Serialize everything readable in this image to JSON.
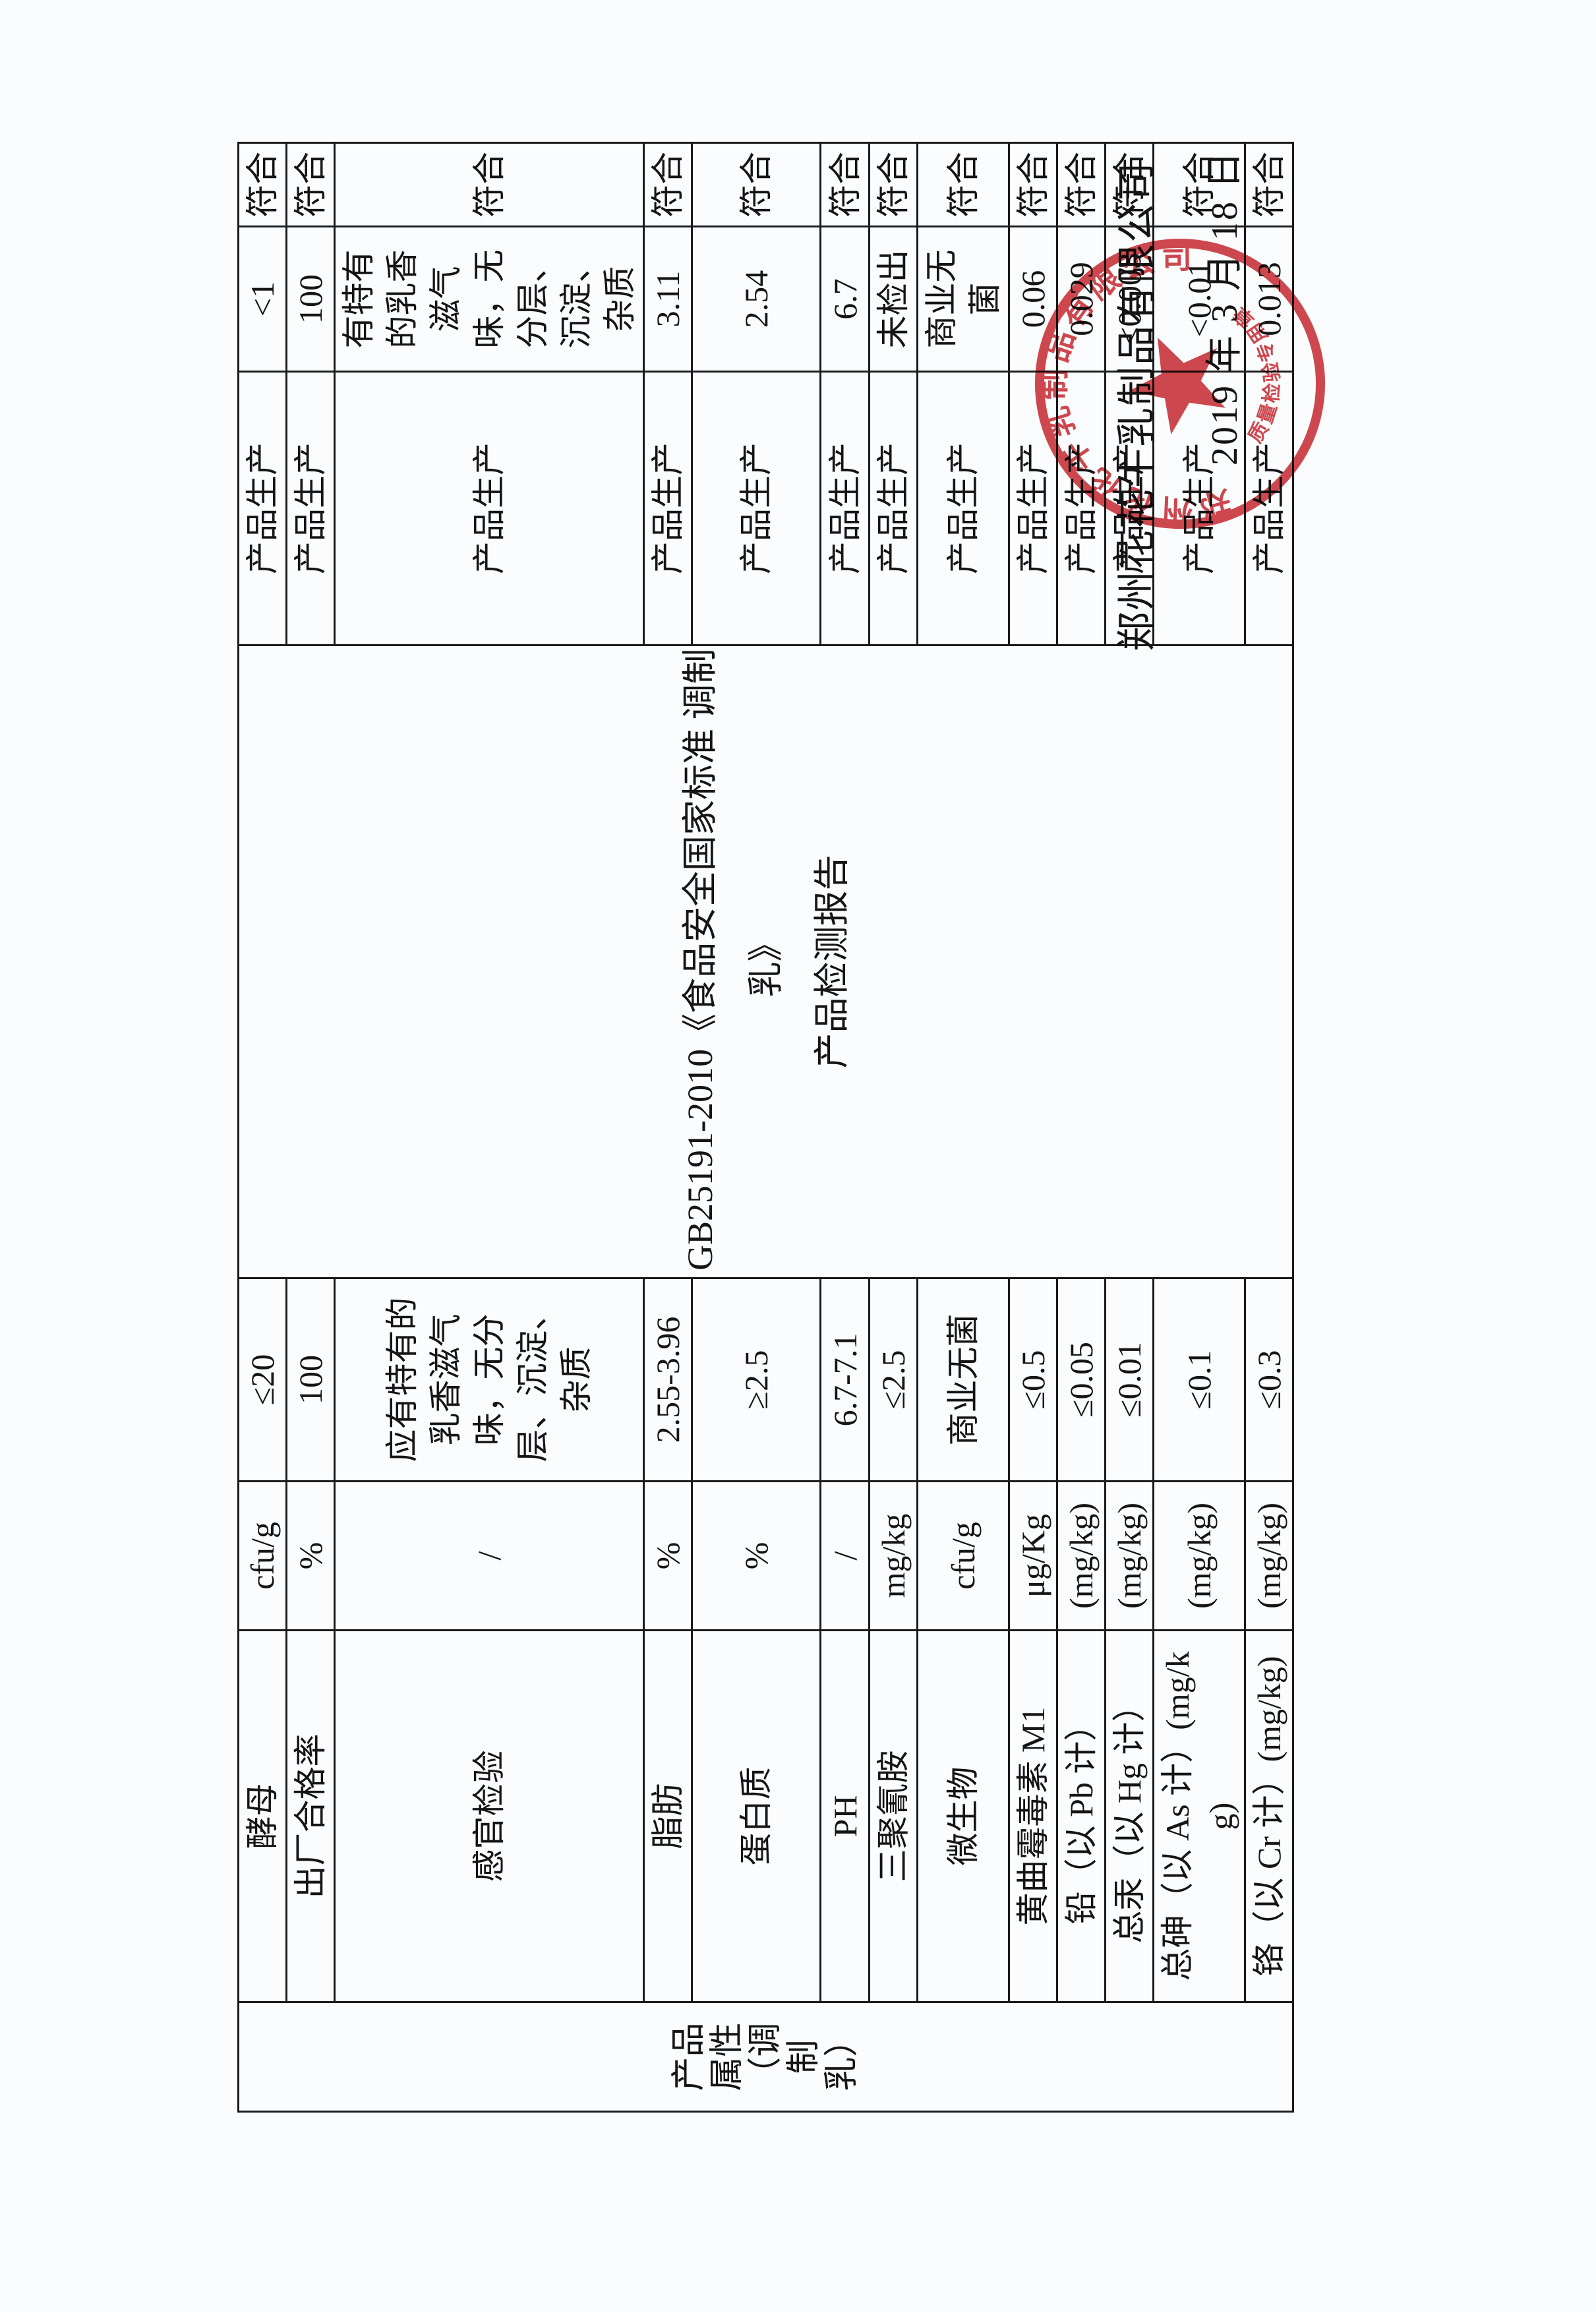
{
  "table": {
    "attribute_label": "产品属性（调制乳）",
    "basis": {
      "l1": "GB25191-2010《食品安全国家标准 调制",
      "l2": "乳》",
      "l3": "产品检测报告"
    },
    "rows": [
      {
        "item": "酵母",
        "unit": "cfu/g",
        "standard": "≤20",
        "source": "产品生产",
        "result": "<1",
        "conclusion": "符合"
      },
      {
        "item": "出厂合格率",
        "unit": "%",
        "standard": "100",
        "source": "产品生产",
        "result": "100",
        "conclusion": "符合"
      },
      {
        "item": "感官检验",
        "unit": "/",
        "standard": "应有特有的乳香滋气味，无分层、沉淀、杂质",
        "source": "产品生产",
        "result": "有特有的乳香滋气味，无分层、沉淀、杂质",
        "conclusion": "符合"
      },
      {
        "item": "脂肪",
        "unit": "%",
        "standard": "2.55-3.96",
        "source": "产品生产",
        "result": "3.11",
        "conclusion": "符合"
      },
      {
        "item": "蛋白质",
        "unit": "%",
        "standard": "≥2.5",
        "source": "产品生产",
        "result": "2.54",
        "conclusion": "符合"
      },
      {
        "item": "PH",
        "unit": "/",
        "standard": "6.7-7.1",
        "source": "产品生产",
        "result": "6.7",
        "conclusion": "符合"
      },
      {
        "item": "三聚氰胺",
        "unit": "mg/kg",
        "standard": "≤2.5",
        "source": "产品生产",
        "result": "未检出",
        "conclusion": "符合"
      },
      {
        "item": "微生物",
        "unit": "cfu/g",
        "standard": "商业无菌",
        "source": "产品生产",
        "result": "商业无菌",
        "conclusion": "符合"
      },
      {
        "item": "黄曲霉毒素 M1",
        "unit": "μg/Kg",
        "standard": "≤0.5",
        "source": "产品生产",
        "result": "0.06",
        "conclusion": "符合"
      },
      {
        "item": "铅（以 Pb 计）",
        "unit": "(mg/kg)",
        "standard": "≤0.05",
        "source": "产品生产",
        "result": "0.029",
        "conclusion": "符合"
      },
      {
        "item": "总汞（以 Hg 计）",
        "unit": "(mg/kg)",
        "standard": "≤0.01",
        "source": "产品生产",
        "result": "<0.003",
        "conclusion": "符合"
      },
      {
        "item": "总砷（以 As 计）(mg/kg)",
        "unit": "(mg/kg)",
        "standard": "≤0.1",
        "source": "产品生产",
        "result": "<0.01",
        "conclusion": "符合"
      },
      {
        "item": "铬（以 Cr 计）(mg/kg)",
        "unit": "(mg/kg)",
        "standard": "≤0.3",
        "source": "产品生产",
        "result": "0.013",
        "conclusion": "符合"
      }
    ]
  },
  "signature": {
    "company": "郑州花花牛乳制品有限公司",
    "date": "2019 年 3 月 18 日"
  },
  "stamp": {
    "arc_text": "郑州花花牛乳制品有限公司",
    "bottom_text": "质量检验专用章",
    "color": "#c5272f"
  }
}
